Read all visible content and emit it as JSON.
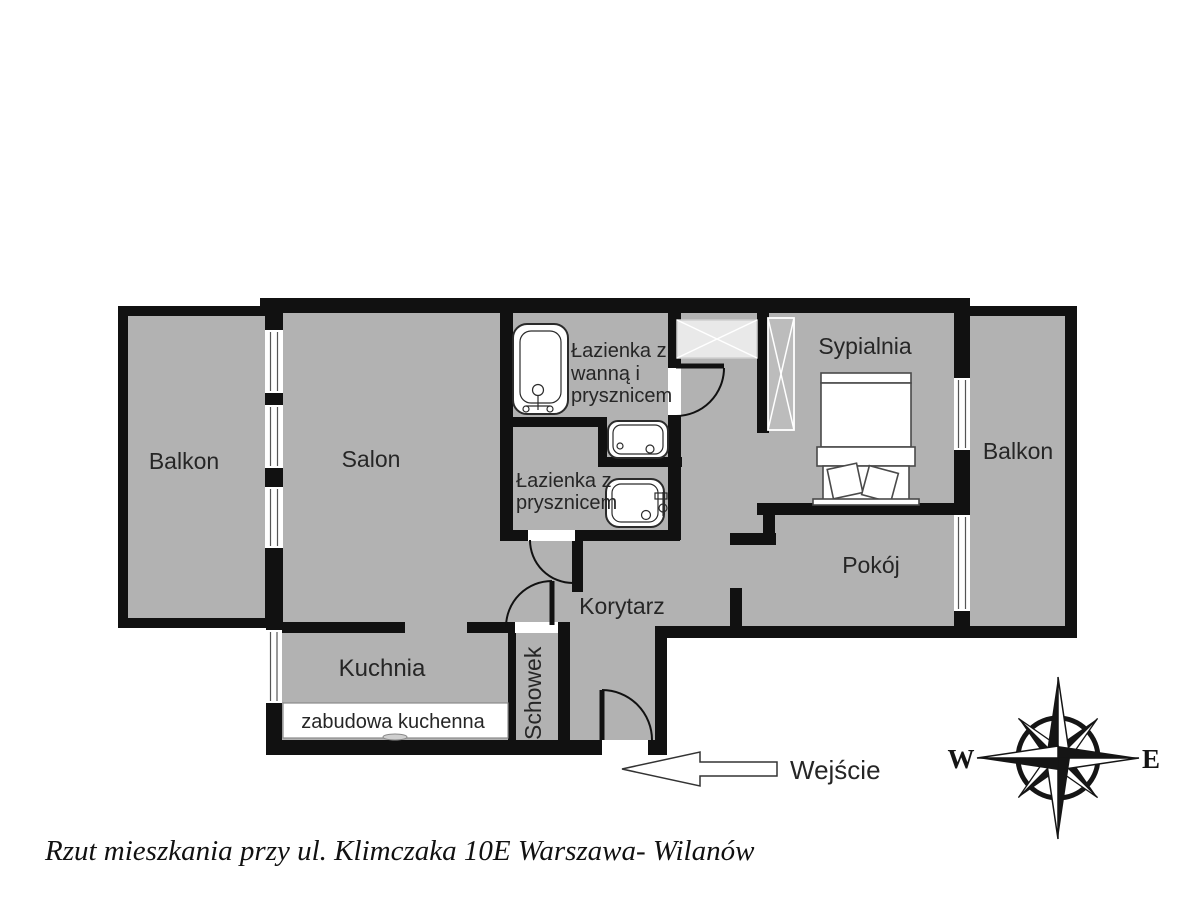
{
  "floorplan": {
    "rooms": {
      "balkon_left": "Balkon",
      "salon": "Salon",
      "bathroom1": [
        "Łazienka z",
        "wanną i",
        "prysznicem"
      ],
      "bathroom2": [
        "Łazienka z",
        "prysznicem"
      ],
      "sypialnia": "Sypialnia",
      "balkon_right": "Balkon",
      "pokoj": "Pokój",
      "korytarz": "Korytarz",
      "kuchnia": "Kuchnia",
      "schowek": "Schowek",
      "zabudowa": "zabudowa kuchenna"
    },
    "entrance_label": "Wejście",
    "compass": {
      "west": "W",
      "east": "E"
    },
    "caption": "Rzut mieszkania przy ul. Klimczaka 10E Warszawa- Wilanów",
    "colors": {
      "floor": "#b2b2b2",
      "wall": "#111111",
      "background": "#ffffff"
    }
  }
}
